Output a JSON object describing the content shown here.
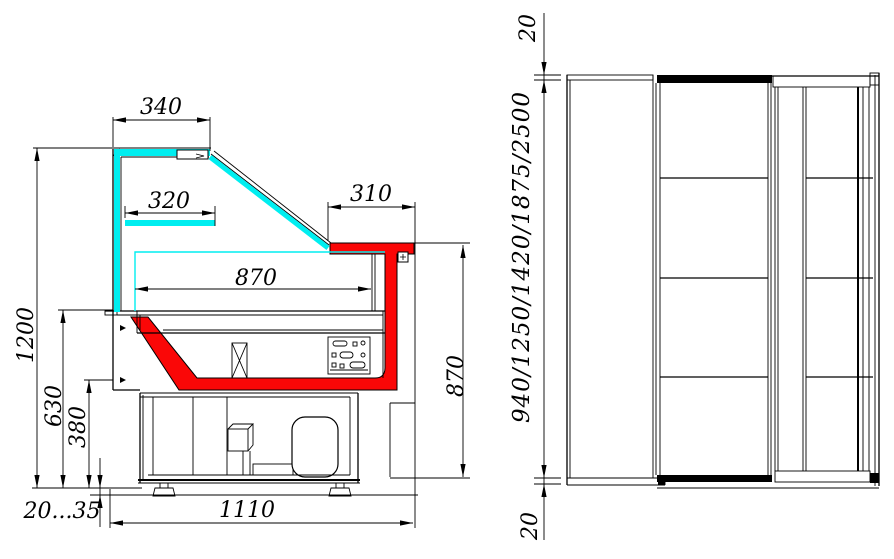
{
  "drawing": {
    "description": "Refrigerated display counter technical drawing, side section and front elevation",
    "colors": {
      "glass_cyan": "#00eef0",
      "accent_red": "#fa0707",
      "line": "#000000",
      "background": "#ffffff"
    },
    "side_view": {
      "dims": {
        "canopy_width": "340",
        "shelf_width": "320",
        "worktop_depth": "310",
        "deck_width": "870",
        "overall_height": "1200",
        "deck_height": "630",
        "base_height": "380",
        "feet_range": "20...35",
        "base_depth": "1110",
        "rear_height": "870"
      }
    },
    "front_view": {
      "dims": {
        "top_edge": "20",
        "length_options": "940/1250/1420/1875/2500",
        "bottom_edge": "20"
      }
    }
  }
}
